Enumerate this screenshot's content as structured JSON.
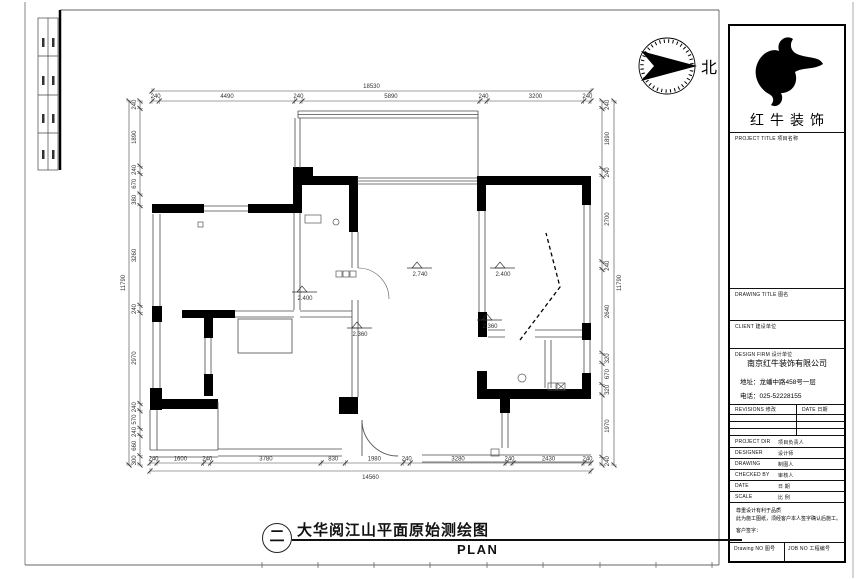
{
  "north": {
    "label": "北"
  },
  "footer": {
    "index_symbol": "二",
    "title": "大华阅江山平面原始测绘图",
    "subtitle": "PLAN"
  },
  "title_block": {
    "logo_text": "红牛装饰",
    "sections": {
      "project_title": "PROJECT TITLE  项目名称",
      "drawing_title": "DRAWING TITLE  图名",
      "client": "CLIENT  建设单位",
      "design_firm": "DESIGN FIRM  设计单位"
    },
    "company": {
      "name": "南京红牛装饰有限公司",
      "address": "地址：龙蟠中路458号一层",
      "phone": "电话：025-52228155"
    },
    "revisions": {
      "col1": "REVISIONS  修改",
      "col2": "DATE 日期"
    },
    "fields": [
      {
        "label": "PROJECT DIR",
        "cn": "项目负责人"
      },
      {
        "label": "DESIGNER",
        "cn": "设计师"
      },
      {
        "label": "DRAWING",
        "cn": "制图人"
      },
      {
        "label": "CHECKED BY",
        "cn": "审核人"
      },
      {
        "label": "DATE",
        "cn": "日  期"
      },
      {
        "label": "SCALE",
        "cn": "比  例"
      }
    ],
    "note_lines": [
      "尊重设计有利于品质",
      "此为施工图纸，须经客户本人签字确认后施工。",
      "客户签字："
    ],
    "bottom": {
      "drawing_no": "Drawing NO  图号",
      "job_no": "JOB NO  工程编号"
    }
  },
  "plan": {
    "dimensions": {
      "top": {
        "total": "18530",
        "segments": [
          "240",
          "4490",
          "240",
          "5890",
          "240",
          "3200",
          "240"
        ]
      },
      "bottom": {
        "total": "14560",
        "segments": [
          "240",
          "1600",
          "240",
          "3780",
          "830",
          "1980",
          "240",
          "3280",
          "240",
          "2430",
          "240"
        ]
      },
      "left": {
        "total": "11790",
        "segments": [
          "240",
          "1890",
          "240",
          "670",
          "380",
          "3260",
          "240",
          "2970",
          "240",
          "570",
          "240",
          "660",
          "300"
        ]
      },
      "right": {
        "total": "11790",
        "segments": [
          "240",
          "1890",
          "240",
          "2700",
          "240",
          "2640",
          "320",
          "670",
          "320",
          "1970",
          "240"
        ]
      }
    },
    "elevation_markers": [
      {
        "x": 302,
        "y": 292,
        "label": "2.400"
      },
      {
        "x": 417,
        "y": 268,
        "label": "2.740"
      },
      {
        "x": 500,
        "y": 268,
        "label": "2.400"
      },
      {
        "x": 357,
        "y": 328,
        "label": "2.360"
      },
      {
        "x": 487,
        "y": 320,
        "label": "2.360"
      }
    ]
  },
  "colors": {
    "wall": "#000000",
    "line": "#4a4a4a",
    "dim": "#444444"
  }
}
